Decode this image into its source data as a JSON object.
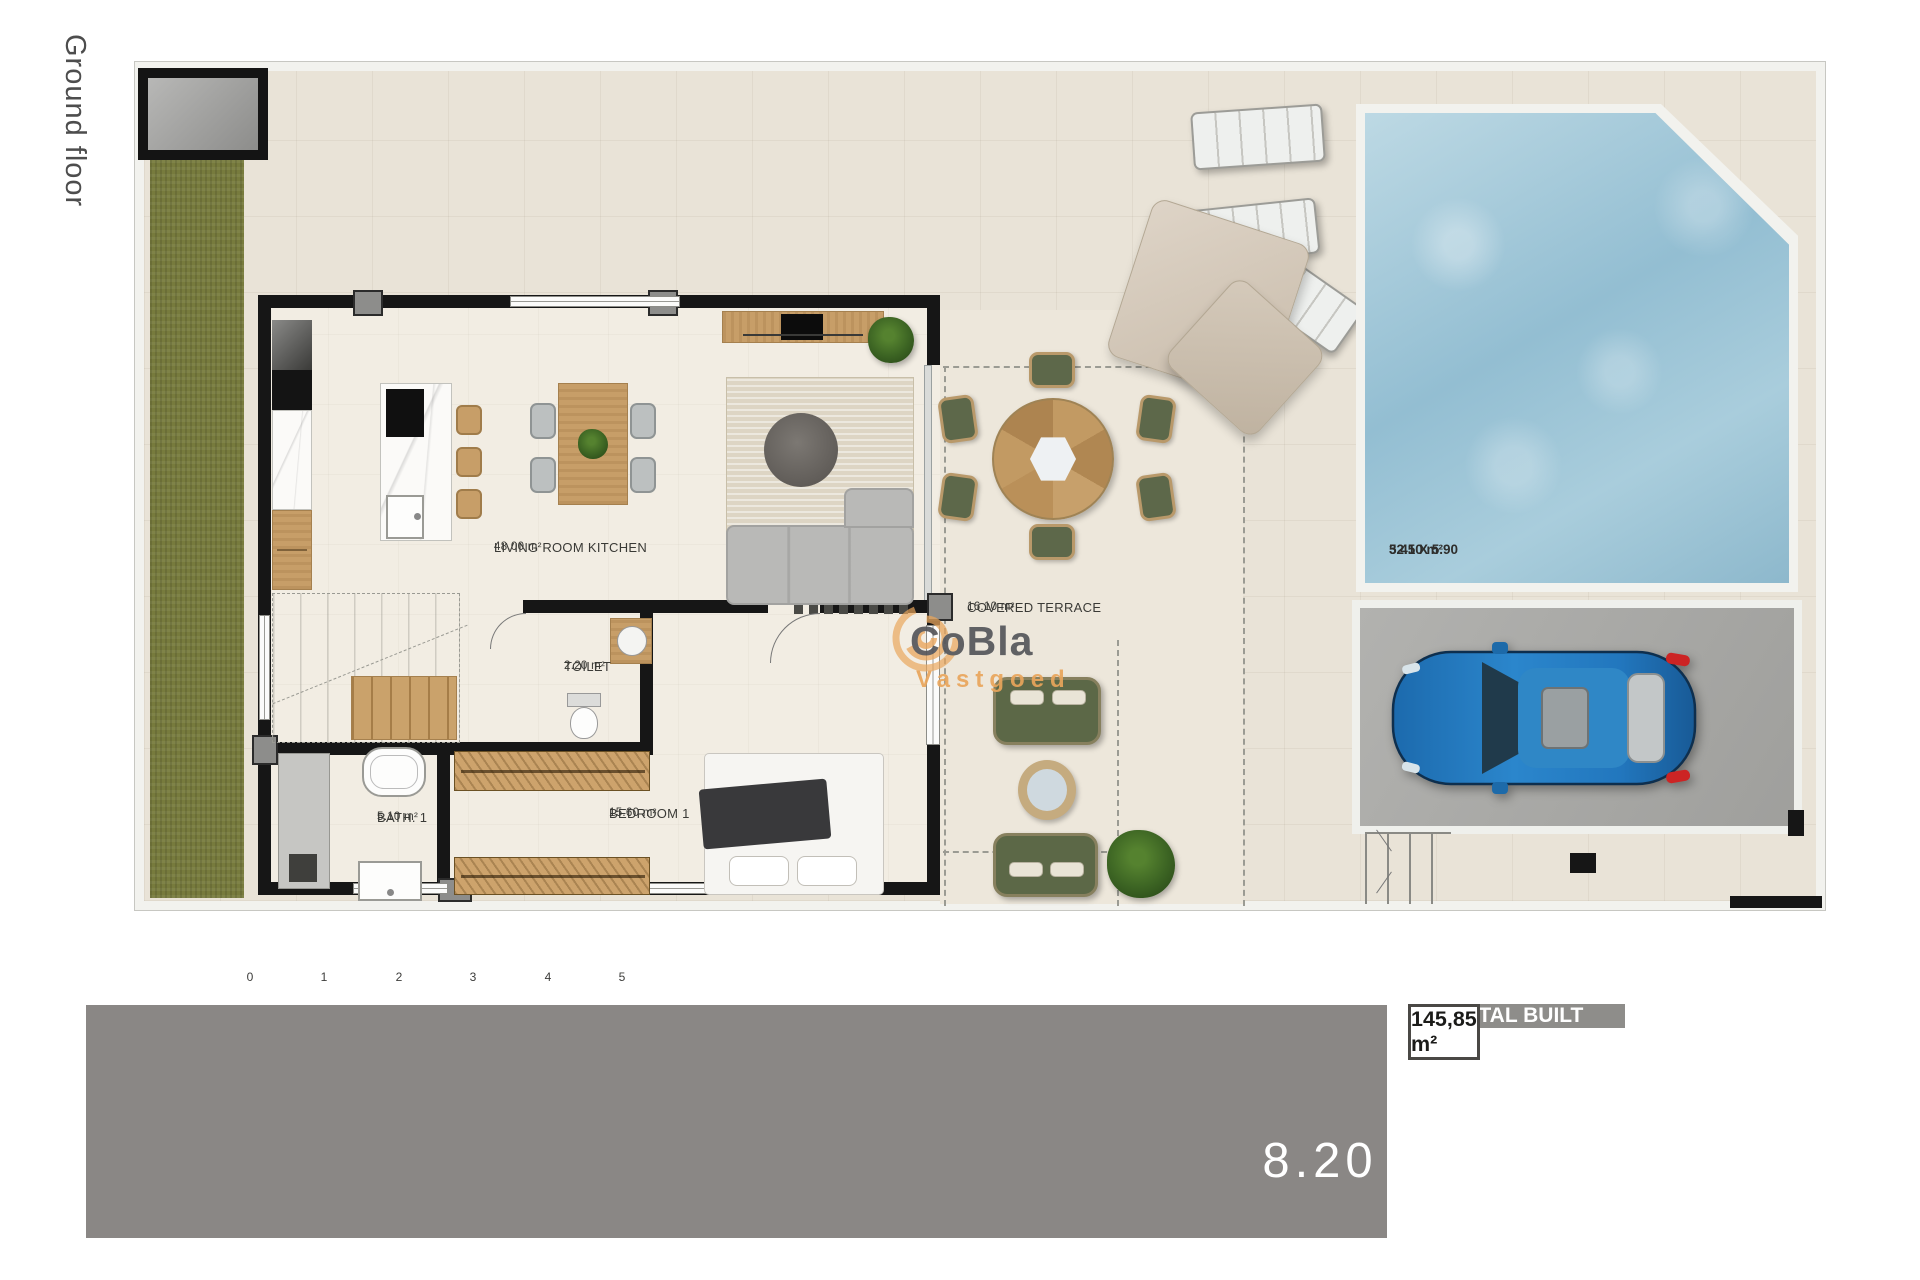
{
  "sidebar": {
    "floor_label": "Ground floor"
  },
  "plan": {
    "rooms": {
      "living": {
        "name": "LIVING ROOM KITCHEN",
        "area": "48.00 m²"
      },
      "toilet": {
        "name": "TOILET",
        "area": "2.20 m²"
      },
      "bath": {
        "name": "BATH. 1",
        "area": "5.10 m²"
      },
      "bedroom": {
        "name": "BEDROOM 1",
        "area": "15.60 m²"
      },
      "covered_terrace": {
        "name": "COVERED TERRACE",
        "area": "16.10 m²"
      }
    },
    "pool": {
      "area": "32.10 m²",
      "dimensions": "5.45 X 5.90"
    },
    "scale_bar": {
      "ticks": [
        "0",
        "1",
        "2",
        "3",
        "4",
        "5"
      ]
    }
  },
  "watermark": {
    "brand": "CoBla",
    "sub": "Vastgoed"
  },
  "footer": {
    "plot_number": "8.20"
  },
  "areas_table": {
    "rows": [
      {
        "label": "PLOT",
        "value": "256,60 m²"
      },
      {
        "label": "Ground floor",
        "value": "79,90 m²"
      },
      {
        "label": "First floor",
        "value": "48,85 m²"
      },
      {
        "label": "Terrace (50%)",
        "value": "12,70 m²"
      },
      {
        "label": "Uncovered terrace",
        "value": "4,40 m²"
      },
      {
        "label": "TOTAL BUILT",
        "value": "145,85 m²"
      }
    ]
  },
  "colors": {
    "accent_orange": "#e9a55b",
    "table_gray": "#8e8d8a",
    "pool_blue": "#a6c9da",
    "grass_green": "#777b3d",
    "car_blue": "#2279be",
    "footer_gray": "#8a8785"
  }
}
